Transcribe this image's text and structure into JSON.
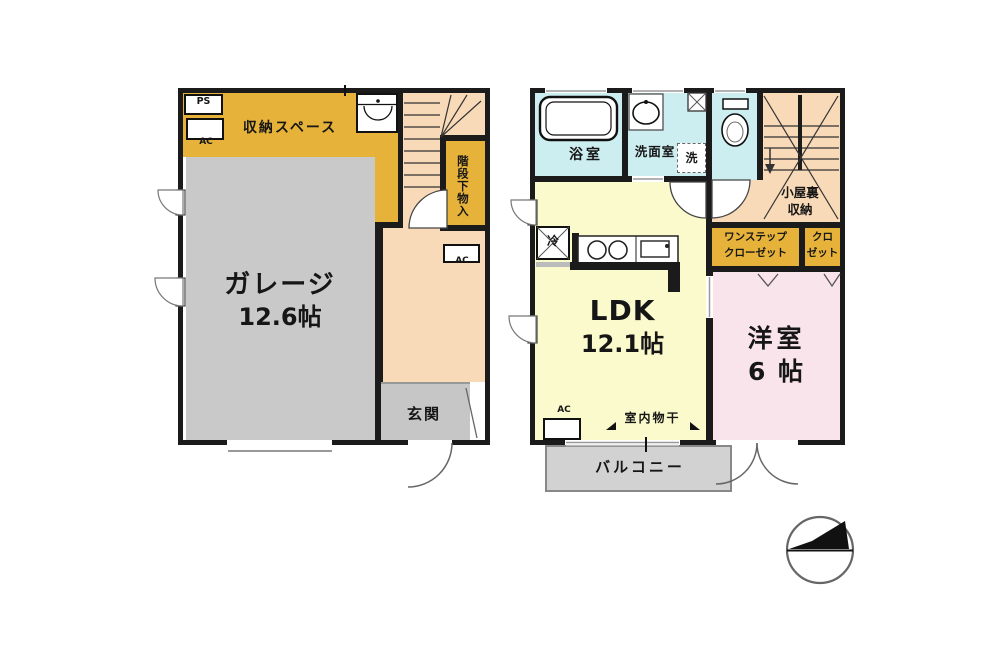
{
  "floor1": {
    "ps": "PS",
    "ac1": "AC",
    "ac2": "AC",
    "storage_space": "収納スペース",
    "under_stair_storage": "階段下物入",
    "garage": {
      "name": "ガレージ",
      "size": "12.6帖"
    },
    "entrance": "玄関"
  },
  "floor2": {
    "bathroom": "浴室",
    "washroom": "洗面室",
    "laundry": "洗",
    "refrigerator": "冷",
    "ac": "AC",
    "attic": {
      "line1": "小屋裏",
      "line2": "収納"
    },
    "one_step_closet": {
      "line1": "ワンステップ",
      "line2": "クローゼット"
    },
    "closet": {
      "line1": "クロ",
      "line2": "ゼット"
    },
    "ldk": {
      "name": "LDK",
      "size": "12.1帖"
    },
    "western_room": {
      "name": "洋室",
      "size": "6 帖"
    },
    "indoor_drying": "室内物干",
    "balcony": "バルコニー"
  },
  "colors": {
    "wall": "#1b1b1b",
    "storage_yellow": "#e6b23a",
    "hall_peach": "#f8d9b8",
    "garage_gray": "#c9c9c9",
    "entrance_gray": "#c6c6c6",
    "wet_area_cyan": "#cdeef0",
    "ldk_yellow": "#fafacd",
    "bedroom_pink": "#fae4ec",
    "balcony_gray": "#d2d2d2"
  },
  "icons": [
    "bathtub-icon",
    "washbasin-icon",
    "toilet-icon",
    "utility-sink-icon",
    "kitchen-counter-icon",
    "refrigerator-icon",
    "pipe-shaft-icon",
    "ac-outdoor-unit-icon",
    "door-swing-icon",
    "window-swing-icon",
    "stairs-icon",
    "laundry-hook-icon",
    "north-arrow-icon"
  ]
}
